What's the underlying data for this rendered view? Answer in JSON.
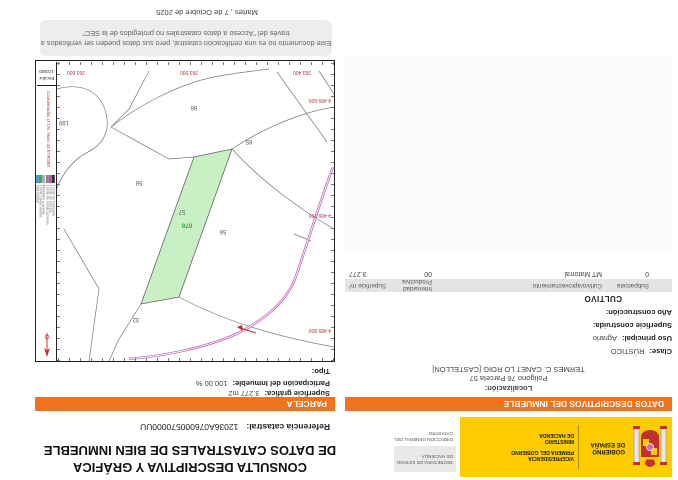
{
  "header": {
    "logo": {
      "gobierno_l1": "GOBIERNO",
      "gobierno_l2": "DE ESPAÑA",
      "vicepresidencia_l1": "VICEPRESIDENCIA",
      "vicepresidencia_l2": "PRIMERA DEL GOBIERNO",
      "ministerio_l1": "MINISTERIO",
      "ministerio_l2": "DE HACIENDA",
      "secretaria": "SECRETARÍA DE ESTADO DE HACIENDA",
      "direccion": "DIRECCIÓN GENERAL DEL CATASTRO",
      "yellow": "#ffcc00"
    },
    "title_l1": "CONSULTA DESCRIPTIVA Y GRÁFICA",
    "title_l2": "DE DATOS CATASTRALES DE BIEN INMUEBLE",
    "ref_label": "Referencia catastral:",
    "ref_value": "12036A076000570000UU"
  },
  "left": {
    "banner": "DATOS DESCRIPTIVOS DEL INMUEBLE",
    "localizacion_label": "Localización:",
    "localizacion_l1": "Polígono 76 Parcela 57",
    "localizacion_l2": "TERMES C. CANET LO ROIG [CASTELLÓN]",
    "clase_label": "Clase:",
    "clase_value": "RÚSTICO",
    "uso_label": "Uso principal:",
    "uso_value": "Agrario",
    "sup_construida_label": "Superficie construida:",
    "anio_label": "Año construcción:",
    "cultivo_title": "CULTIVO",
    "table": {
      "headers": [
        "Subparcela",
        "Cultivo/aprovechamiento",
        "Intensidad Productiva",
        "Superficie m²"
      ],
      "rows": [
        [
          "0",
          "MT Matorral",
          "00",
          "3.277"
        ]
      ]
    }
  },
  "right": {
    "banner": "PARCELA",
    "sup_grafica_label": "Superficie gráfica:",
    "sup_grafica_value": "3.277 m2",
    "participacion_label": "Participación del Inmueble:",
    "participacion_value": "100.00 %",
    "tipo_label": "Tipo:"
  },
  "map": {
    "highlight_color": "#c9efc5",
    "parcels": [
      "199",
      "86",
      "85",
      "58",
      "57",
      "56",
      "32"
    ],
    "highlight_code": "076",
    "x_ticks": [
      "263.400",
      "263.500",
      "263.600"
    ],
    "y_ticks": [
      "4.489.800",
      "4.489.700",
      "4.489.600"
    ],
    "utm_text": "Coordenadas U.T.M. Huso 31 ETRS89",
    "escala_label": "Escala:",
    "escala_value": "1/2000",
    "legend": [
      "Límite de manzana",
      "Límite de parcela",
      "Límite de construcciones",
      "Mobiliario y aceras",
      "Límite zonas verdes",
      "Hidrografía"
    ]
  },
  "footer": {
    "disclaimer_l1": "Este documento no es una certificación catastral, pero sus datos pueden ser verificados a",
    "disclaimer_l2": "través del \"Acceso a datos catastrales no protegidos de la SEC\"",
    "date": "Martes , 7 de Octubre de 2025"
  }
}
